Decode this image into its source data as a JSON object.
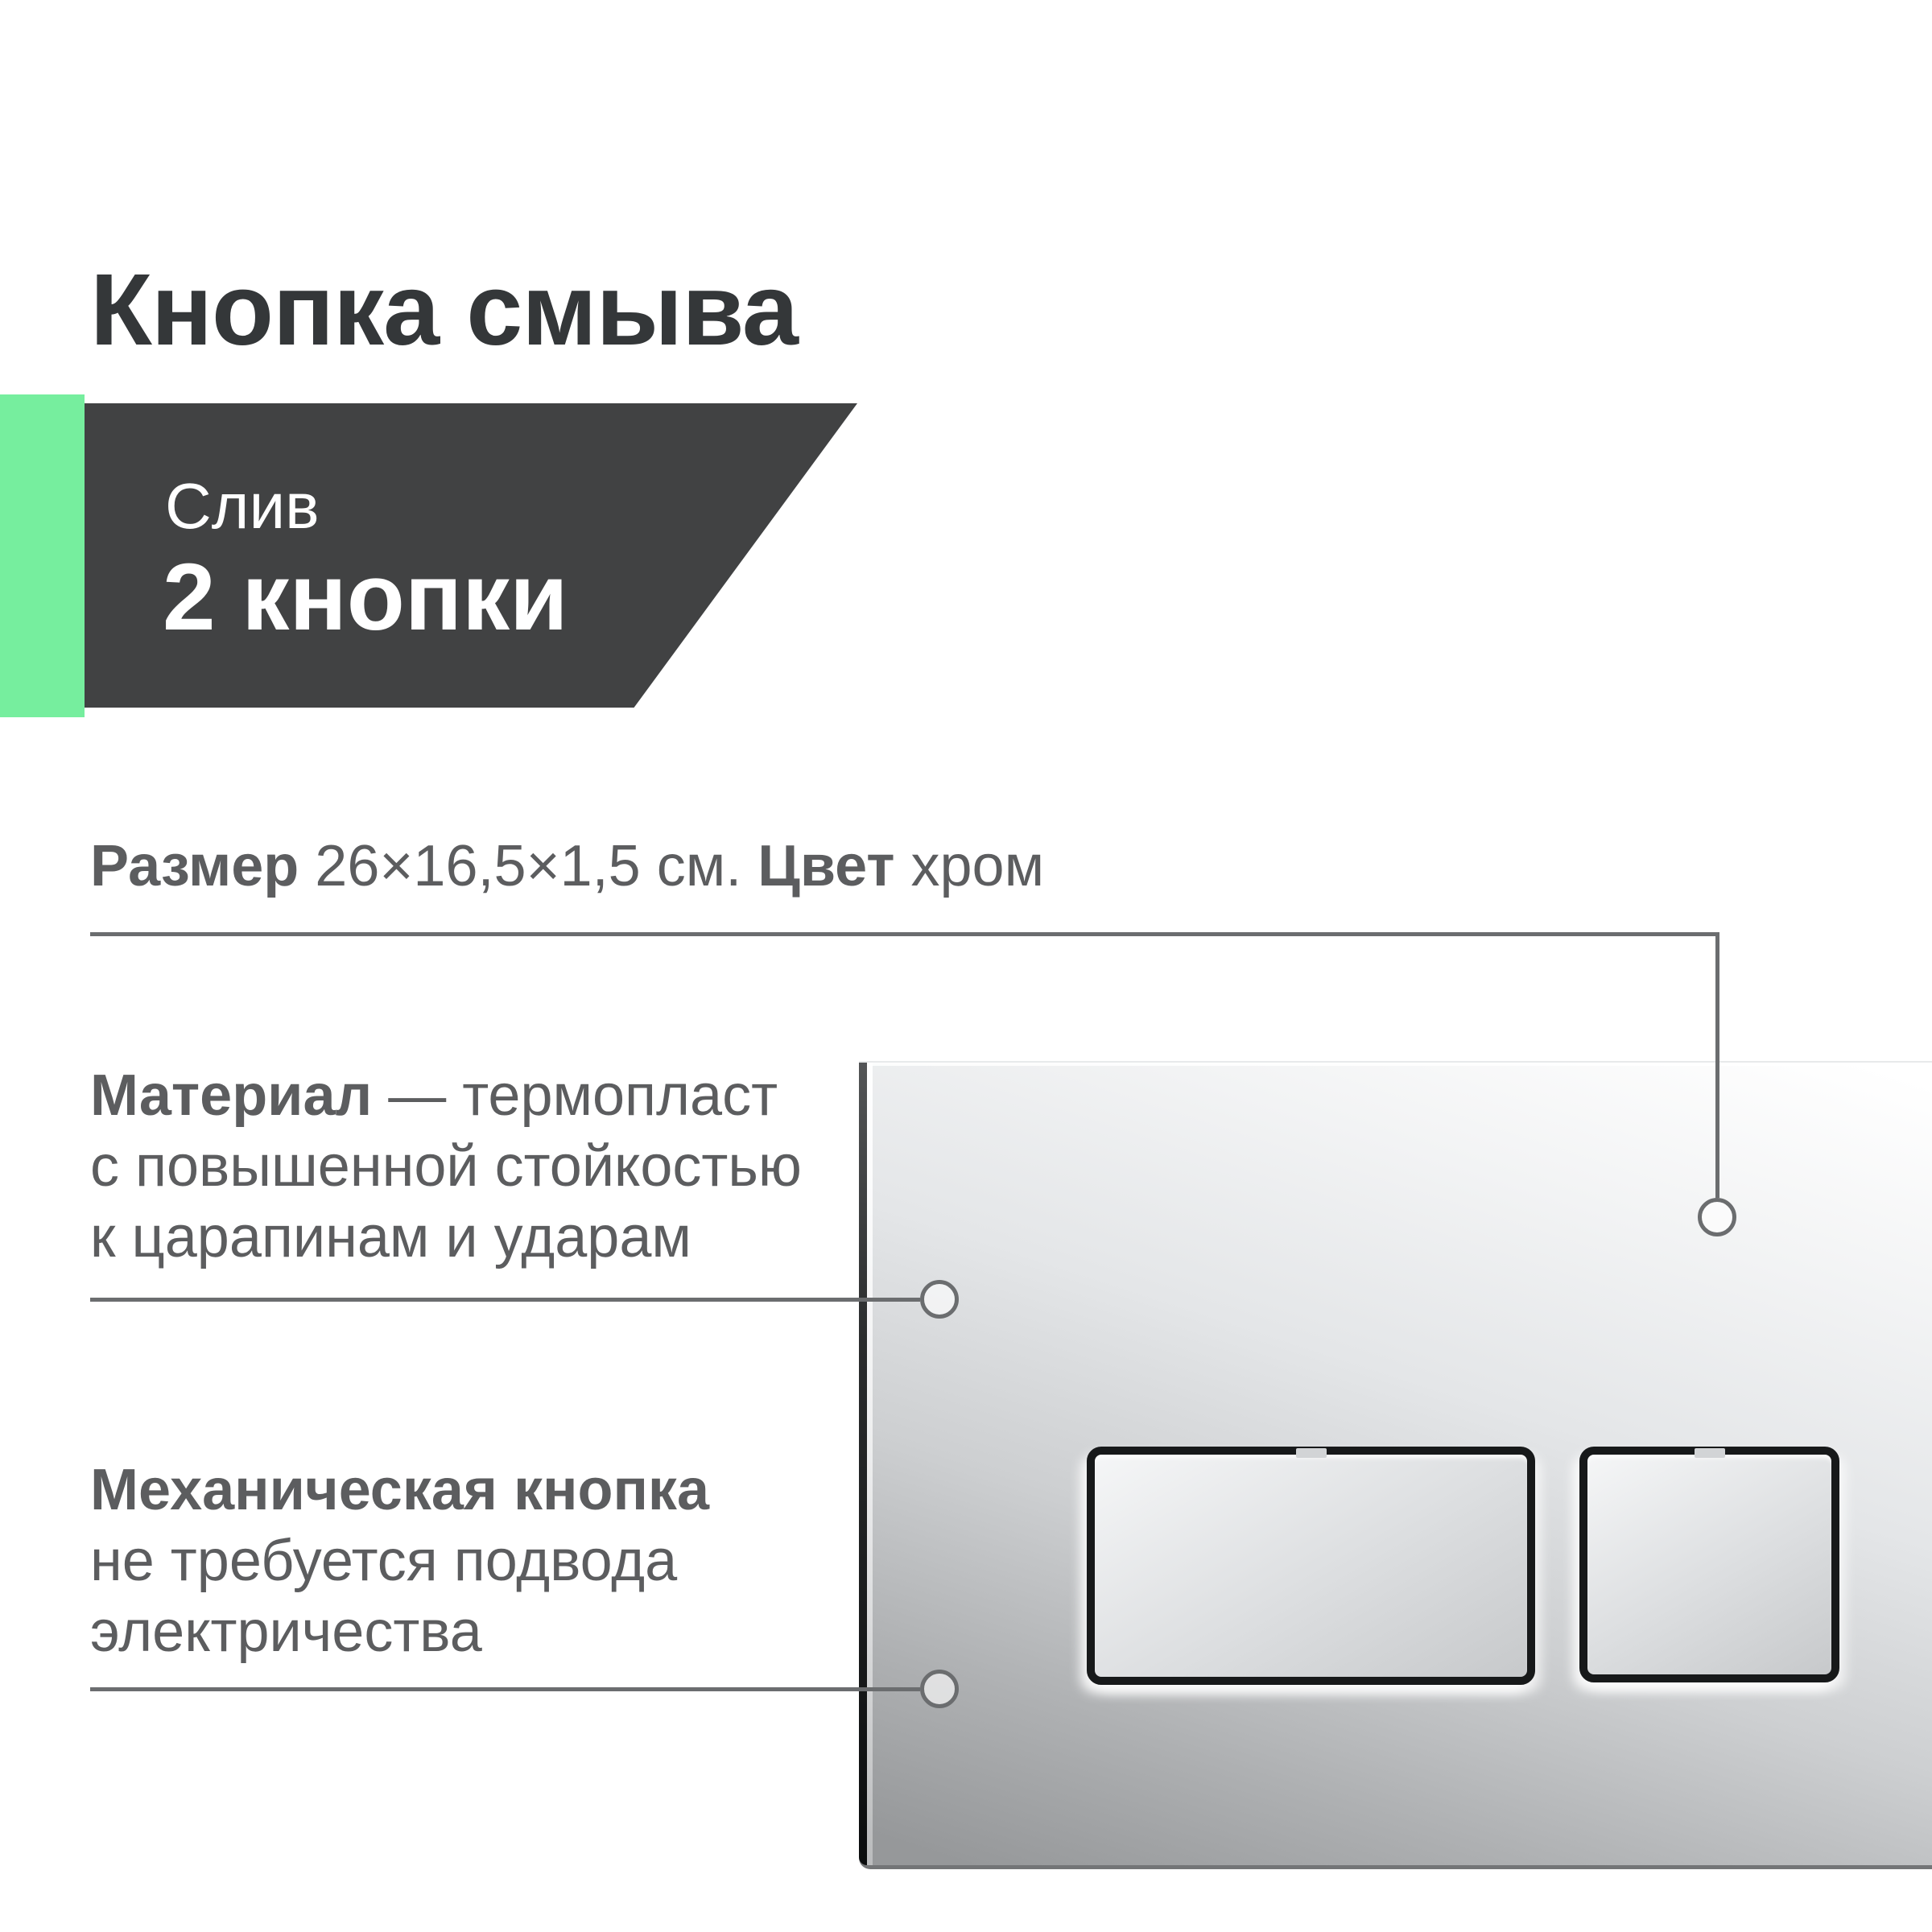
{
  "title": "Кнопка смыва",
  "badge": {
    "subtitle": "Слив",
    "title": "2 кнопки"
  },
  "specs": {
    "size_label": "Размер",
    "size_value": "26×16,5×1,5 см.",
    "color_label": "Цвет",
    "color_value": "хром"
  },
  "material": {
    "lead": "Материал",
    "rest": "— термопласт",
    "line2": "с повышенной стойкостью",
    "line3": "к царапинам и ударам"
  },
  "mechanical": {
    "lead": "Механическая кнопка",
    "line2": "не требуется подвода",
    "line3": "электричества"
  },
  "colors": {
    "accent_green": "#76ee9e",
    "badge_dark": "#414243",
    "title_text": "#343739",
    "body_text": "#5c5d5f",
    "callout": "#6b6d6f"
  }
}
